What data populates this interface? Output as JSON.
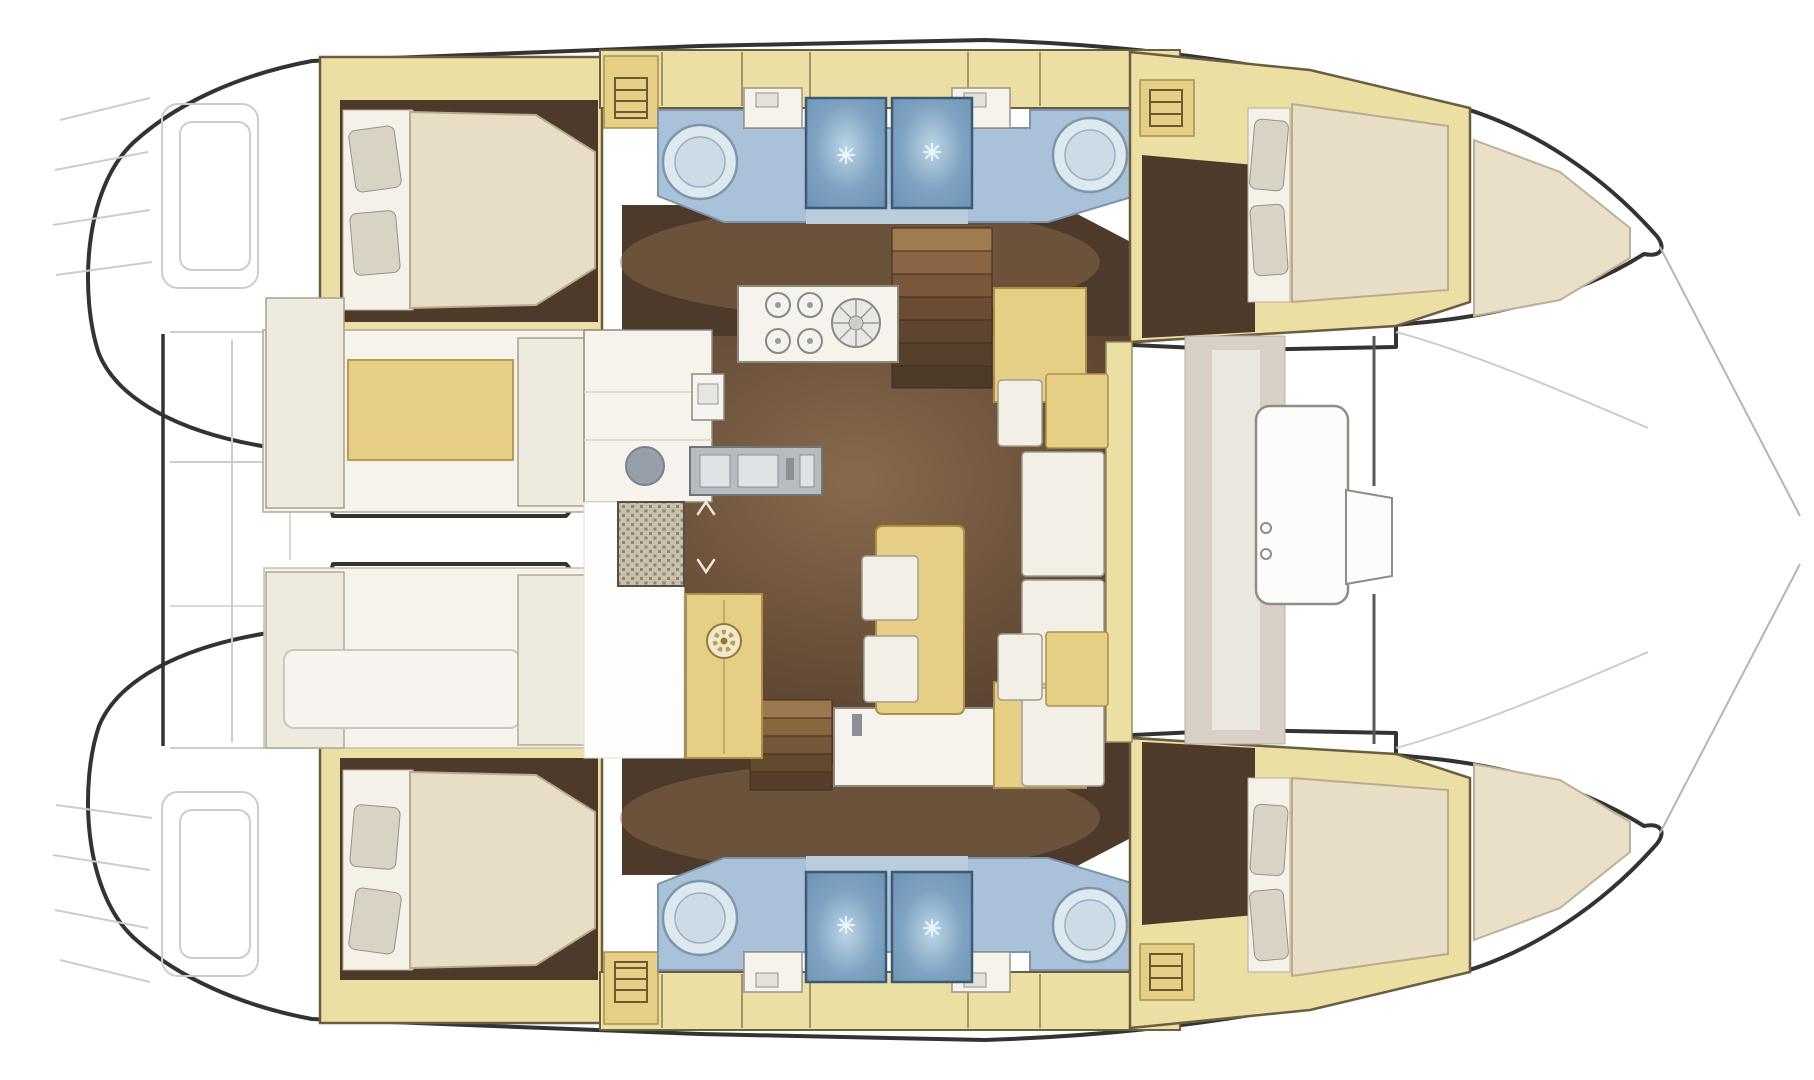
{
  "diagram": {
    "kind": "boat-floor-plan",
    "vessel": "catamaran",
    "view": "overhead",
    "features": {
      "double_berths": 4,
      "shower_stalls": 4,
      "washbasins": 4,
      "stove_burners": 4,
      "salon_table": 1,
      "staircases": 2
    }
  },
  "palette": {
    "canvas": "#ffffff",
    "hull_outline": "#333333",
    "faint_line": "#cccccc",
    "wall_tan": "#ecdfa4",
    "furniture_tan": "#e6cf85",
    "furniture_border": "#ad8f4a",
    "floor_dark": "#4e3a2a",
    "floor_light": "#8a6a4c",
    "bed_cream": "#e8ddc5",
    "bed_sheet": "#f4f1e9",
    "pillow": "#d9d3c6",
    "counter_white": "#f5f3ec",
    "seat_white": "#f2efe7",
    "counter_blue": "#a9c2da",
    "shower_blue": "#6e94b6",
    "shower_glow": "#bcd6e8",
    "tray_blue": "#b9cddc",
    "sink_gray": "#97a0a8",
    "appliance_gray": "#b6bcc0",
    "grate": "#c9c0ae",
    "greige": "#d8d0c6"
  }
}
